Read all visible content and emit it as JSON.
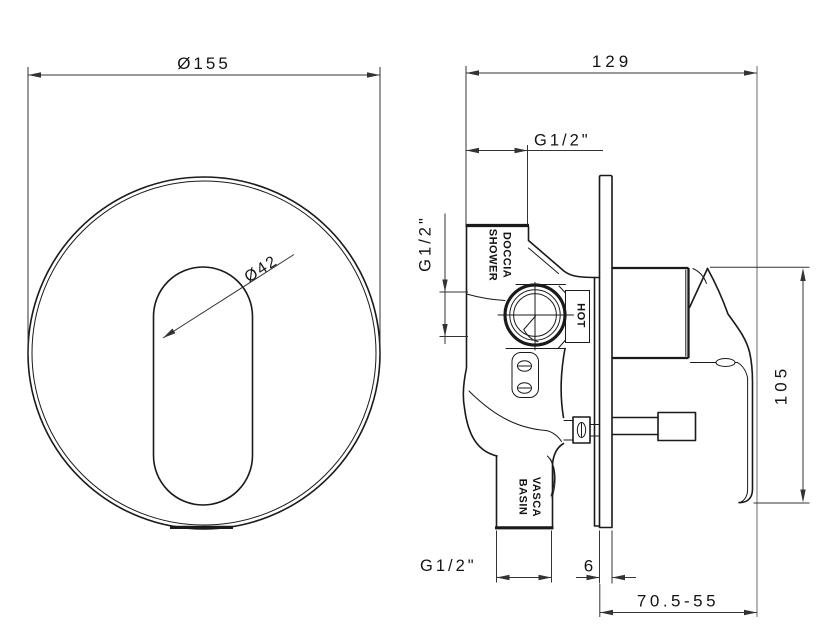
{
  "drawing": {
    "background": "#ffffff",
    "line_color": "#1a1a1a",
    "dim_color": "#333333"
  },
  "front_view": {
    "plate_diameter_label": "Ø155",
    "hole_diameter_label": "Ø42"
  },
  "side_view": {
    "overall_width_label": "129",
    "top_connection_label": "G1/2\"",
    "side_connection_label": "G1/2\"",
    "bottom_connection_label": "G1/2\"",
    "height_label": "105",
    "plate_thickness_label": "6",
    "installation_depth_label": "70.5-55",
    "ports": {
      "shower_line1": "DOCCIA",
      "shower_line2": "SHOWER",
      "hot": "HOT",
      "basin_line1": "VASCA",
      "basin_line2": "BASIN"
    }
  }
}
